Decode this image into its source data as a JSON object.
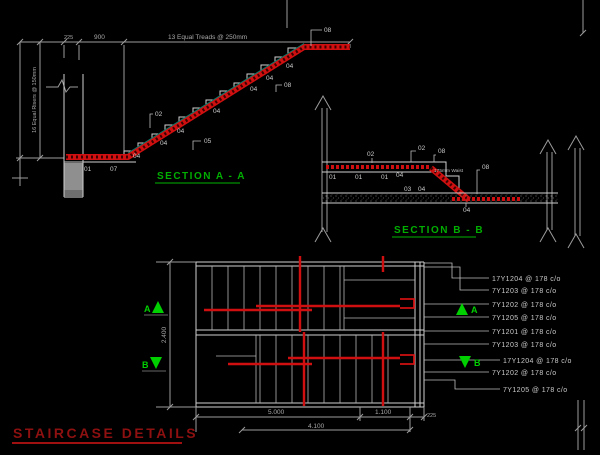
{
  "colors": {
    "background": "#000000",
    "rebar_red": "#d01010",
    "outline_white": "#cfcfcf",
    "dim_gray": "#a8a8a8",
    "section_title_green": "#00ae00",
    "marker_green": "#00d000",
    "drawing_title_red": "#8e1010",
    "waist_teal": "#0e7a6a",
    "wall_gray": "#8f8f8f"
  },
  "section_a": {
    "title": "SECTION  A - A",
    "dim_225": "225",
    "dim_900": "900",
    "dim_treads": "13 Equal Treads @ 250mm",
    "dim_risers": "16 Equal Risers @ 150mm",
    "bar_labels": [
      "01",
      "07",
      "04",
      "04",
      "05",
      "02",
      "04",
      "04",
      "04",
      "04",
      "08",
      "04",
      "08"
    ]
  },
  "section_b": {
    "title": "SECTION  B - B",
    "waist_note": "175mm Waist",
    "bar_labels": [
      "02",
      "02",
      "08",
      "01",
      "01",
      "01",
      "04",
      "03",
      "04",
      "08",
      "04"
    ]
  },
  "plan": {
    "dim_height": "2.400",
    "dims_bottom": {
      "d1": "5.000",
      "d2": "1.100",
      "d3": "225",
      "d4": "4.100"
    },
    "markers": {
      "a": "A",
      "b": "B"
    },
    "callouts": [
      "17Y1204 @ 178 c/o",
      "7Y1203 @ 178 c/o",
      "7Y1202 @ 178 c/o",
      "7Y1205 @ 178 c/o",
      "7Y1201 @ 178 c/o",
      "7Y1203 @ 178 c/o",
      "17Y1204 @ 178 c/o",
      "7Y1202 @ 178 c/o",
      "7Y1205 @ 178 c/o"
    ]
  },
  "drawing_title": "STAIRCASE  DETAILS"
}
